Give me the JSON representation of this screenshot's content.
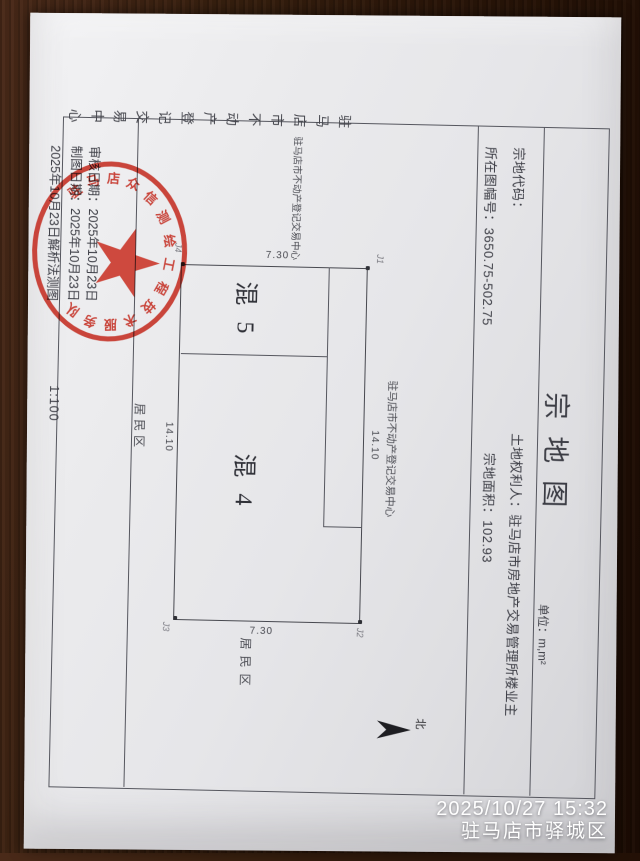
{
  "colors": {
    "seal_red": "#c5352a",
    "paper": "#e8e8ea",
    "wood_brown": "#2c170a",
    "ink": "#3c3d45",
    "timestamp_white": "#fefefe"
  },
  "doc": {
    "title": "宗地图",
    "unit_label": "单位：m,m²",
    "fields": {
      "parcel_code_label": "宗地代码：",
      "map_sheet_label": "所在图幅号：",
      "map_sheet_value": "3650.75-502.75",
      "owner_label": "土地权利人：",
      "owner_value": "驻马店市房地产交易管理所楼业主",
      "area_label": "宗地面积：",
      "area_value": "102.93"
    },
    "map": {
      "corner_j1": "J1",
      "corner_j2": "J2",
      "corner_j3": "J3",
      "corner_j4": "J4",
      "dim_top": "14.10",
      "dim_bottom": "14.10",
      "dim_left": "7.30",
      "dim_right": "7.30",
      "region_left": "混 5",
      "region_right": "混 4",
      "neighbor_top": "驻马店市不动产登记交易中心",
      "neighbor_left": "驻马店市不动产登记交易中心",
      "neighbor_right": "居民区",
      "neighbor_bottom": "居民区",
      "north_label": "北"
    },
    "footer": {
      "review_date_line": "审核日期：2025年10月23日",
      "draw_date_line": "制图日期：2025年10月23日",
      "survey_line": "2025年10月23日解析法测图",
      "scale": "1:100",
      "agency_vertical": "驻马店市不动产登记交易中心"
    },
    "seal": {
      "arc_text": "驻马店众信测绘工程技术服务队",
      "center_text": "报告专用章"
    }
  },
  "photo": {
    "timestamp_line1": "2025/10/27 15:32",
    "timestamp_line2": "驻马店市驿城区"
  }
}
